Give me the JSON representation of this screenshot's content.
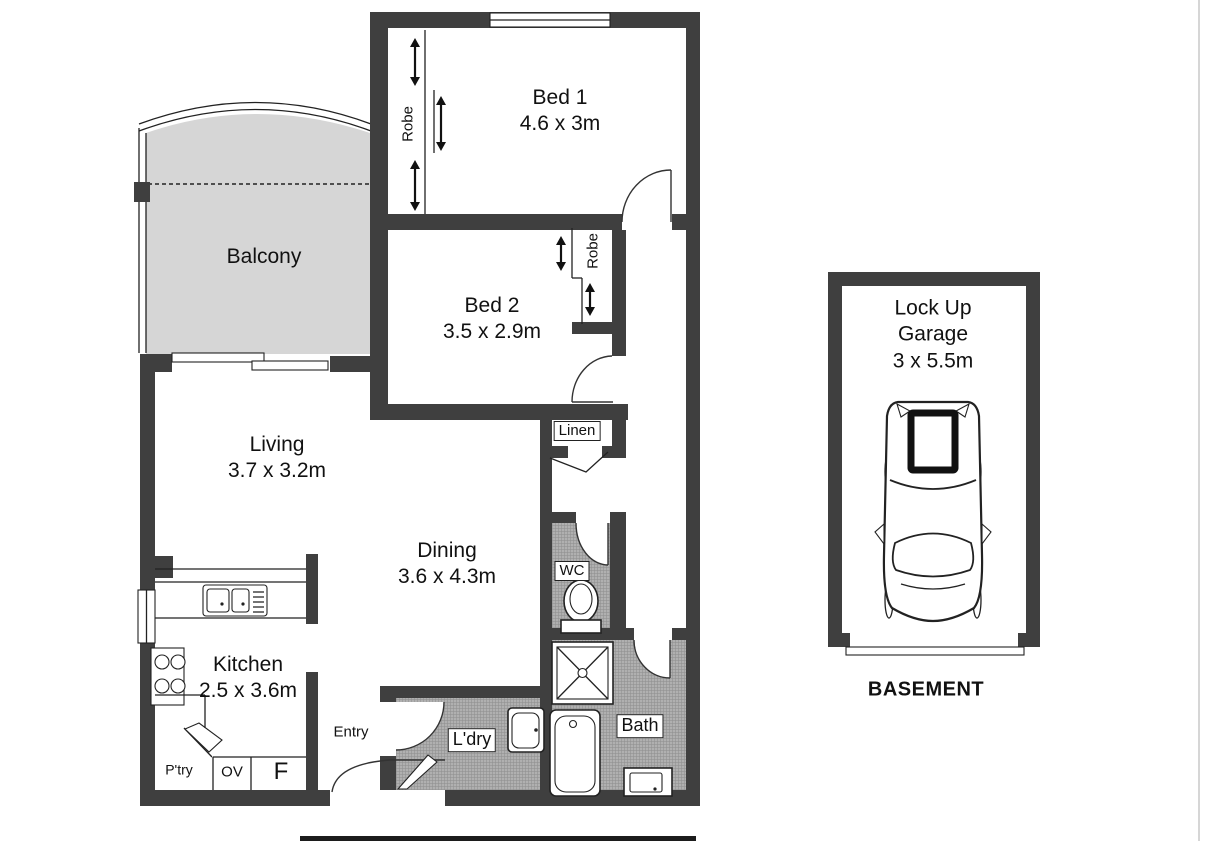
{
  "colors": {
    "wall": "#3f3f3f",
    "balcony_fill": "#d6d6d6",
    "wet_floor": "#b0b0b0",
    "line": "#222222"
  },
  "rooms": {
    "balcony": {
      "label": "Balcony"
    },
    "bed1": {
      "label": "Bed 1",
      "dims": "4.6 x 3m"
    },
    "bed2": {
      "label": "Bed 2",
      "dims": "3.5 x 2.9m"
    },
    "living": {
      "label": "Living",
      "dims": "3.7 x 3.2m"
    },
    "dining": {
      "label": "Dining",
      "dims": "3.6 x 4.3m"
    },
    "kitchen": {
      "label": "Kitchen",
      "dims": "2.5 x 3.6m"
    },
    "bath": {
      "label": "Bath"
    },
    "wc": {
      "label": "WC"
    },
    "laundry": {
      "label": "L'dry"
    },
    "linen": {
      "label": "Linen"
    },
    "entry": {
      "label": "Entry"
    },
    "pantry": {
      "label": "P'try"
    },
    "oven": {
      "label": "OV"
    },
    "fridge": {
      "label": "F"
    },
    "robe1": {
      "label": "Robe"
    },
    "robe2": {
      "label": "Robe"
    }
  },
  "garage": {
    "label_line1": "Lock Up",
    "label_line2": "Garage",
    "dims": "3 x 5.5m",
    "area_label": "BASEMENT"
  }
}
